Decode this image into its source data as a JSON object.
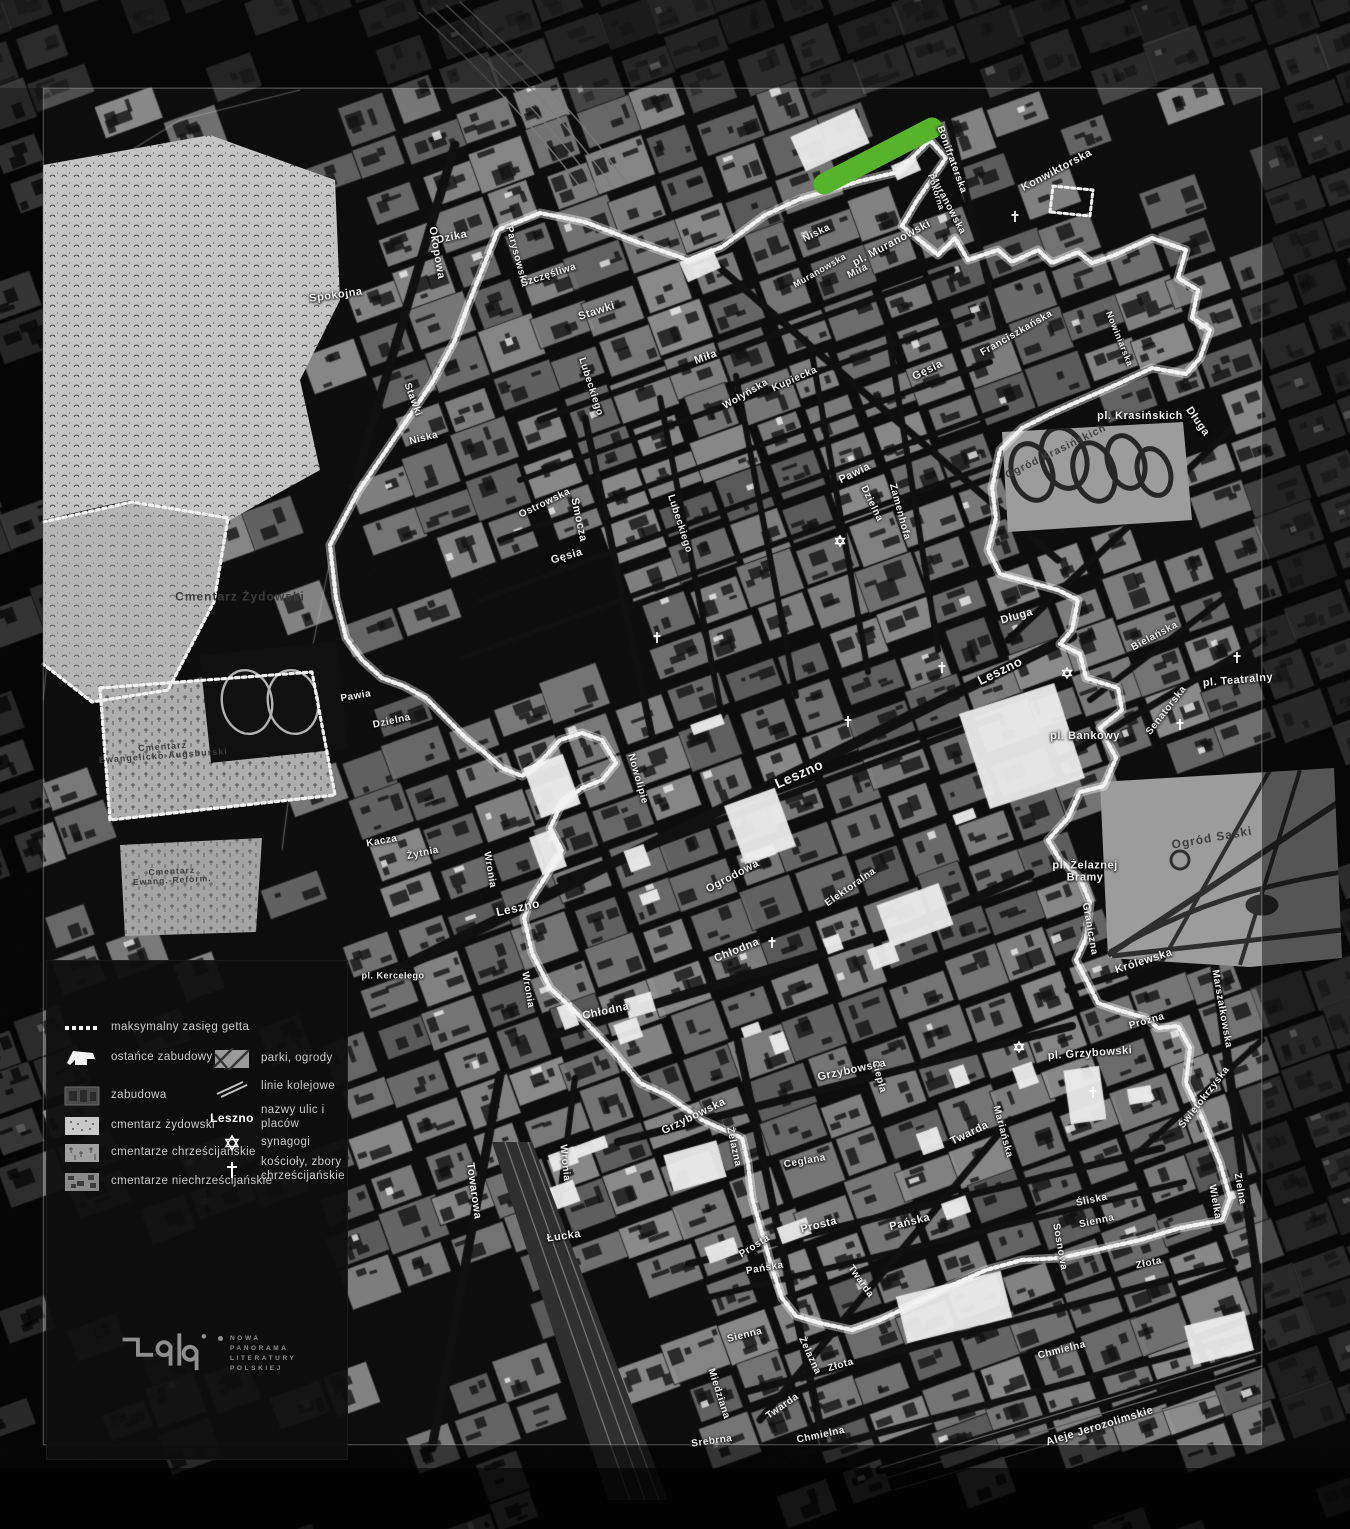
{
  "colors": {
    "background": "#0b0b0b",
    "block_gray": "#8a8a8a",
    "boundary_white": "#f2f2f2",
    "highlight_green": "#57b32c",
    "cemetery_light": "#c4c4c4",
    "park_gray": "#9c9c9c",
    "label_white": "#efefef"
  },
  "legend": {
    "items_left": [
      {
        "swatch": "ghetto-boundary",
        "label": "maksymalny zasięg getta"
      },
      {
        "swatch": "surviving-buildings",
        "label": "ostańce zabudowy"
      },
      {
        "swatch": "buildings",
        "label": "zabudowa"
      },
      {
        "swatch": "jewish-cemetery",
        "label": "cmentarz żydowski"
      },
      {
        "swatch": "christian-cemeteries",
        "label": "cmentarze chrześcijańskie"
      },
      {
        "swatch": "non-christian-cemeteries",
        "label": "cmentarze niechrześcijańskie"
      }
    ],
    "items_right": [
      {
        "swatch": "parks",
        "label": "parki, ogrody"
      },
      {
        "swatch": "railways",
        "label": "linie kolejowe"
      },
      {
        "swatch": "street-name-sample",
        "label": "nazwy ulic i placów",
        "sample": "Leszno"
      },
      {
        "swatch": "synagogue-star",
        "label": "synagogi"
      },
      {
        "swatch": "church-cross",
        "label": "kościoły, zbory\nchrześcijańskie"
      }
    ]
  },
  "logo": {
    "lines": [
      "NOWA",
      "PANORAMA",
      "LITERATURY",
      "POLSKIEJ"
    ]
  },
  "map": {
    "labels": [
      [
        "Dzika",
        452,
        238,
        -12,
        11,
        "street"
      ],
      [
        "Okopowa",
        436,
        253,
        80,
        11,
        "street"
      ],
      [
        "Spokojna",
        336,
        296,
        -8,
        11,
        "street"
      ],
      [
        "Parysowska",
        516,
        257,
        75,
        10,
        "street"
      ],
      [
        "Szczęśliwa",
        549,
        276,
        -18,
        10,
        "street"
      ],
      [
        "Stawki",
        597,
        312,
        -18,
        11,
        "street"
      ],
      [
        "Stawki",
        412,
        400,
        70,
        10,
        "street"
      ],
      [
        "Smocza",
        578,
        520,
        78,
        11,
        "street"
      ],
      [
        "Niska",
        424,
        439,
        -14,
        10,
        "street"
      ],
      [
        "Niska",
        817,
        234,
        -26,
        10,
        "street"
      ],
      [
        "Miła",
        706,
        358,
        -20,
        11,
        "street"
      ],
      [
        "Miła",
        858,
        272,
        -26,
        10,
        "street"
      ],
      [
        "Kupiecka",
        795,
        380,
        -24,
        10,
        "street"
      ],
      [
        "Wołyńska",
        746,
        395,
        -30,
        10,
        "street"
      ],
      [
        "Lubeckiego",
        590,
        387,
        72,
        10,
        "street"
      ],
      [
        "Lubeckiego",
        679,
        524,
        72,
        10,
        "street"
      ],
      [
        "Ostrowska",
        545,
        504,
        -26,
        10,
        "street"
      ],
      [
        "Gęsia",
        567,
        557,
        -16,
        11,
        "street"
      ],
      [
        "Gęsia",
        928,
        371,
        -26,
        11,
        "street"
      ],
      [
        "Pawia",
        855,
        474,
        -26,
        11,
        "street"
      ],
      [
        "Pawia",
        356,
        697,
        -10,
        10,
        "street"
      ],
      [
        "Dzielna",
        871,
        504,
        64,
        10,
        "street"
      ],
      [
        "Dzielna",
        392,
        722,
        -12,
        10,
        "street"
      ],
      [
        "Zamenhofa",
        899,
        512,
        75,
        10,
        "street"
      ],
      [
        "Kacza",
        382,
        842,
        -10,
        10,
        "street"
      ],
      [
        "Żytnia",
        423,
        854,
        -12,
        10,
        "street"
      ],
      [
        "Wronia",
        489,
        870,
        80,
        10,
        "street"
      ],
      [
        "Wronia",
        527,
        990,
        80,
        10,
        "street"
      ],
      [
        "Wronia",
        564,
        1163,
        84,
        10,
        "street"
      ],
      [
        "Leszno",
        1000,
        671,
        -26,
        13,
        "street"
      ],
      [
        "Leszno",
        799,
        774,
        -24,
        14,
        "street"
      ],
      [
        "Leszno",
        518,
        908,
        -12,
        12,
        "street"
      ],
      [
        "Nowolipie",
        637,
        779,
        74,
        10,
        "street"
      ],
      [
        "Ogrodowa",
        733,
        877,
        -28,
        11,
        "street"
      ],
      [
        "Chłodna",
        737,
        951,
        -22,
        11,
        "street"
      ],
      [
        "Chłodna",
        606,
        1012,
        -12,
        11,
        "street"
      ],
      [
        "Elektoralna",
        851,
        888,
        -35,
        10,
        "street"
      ],
      [
        "Towarowa",
        473,
        1191,
        82,
        11,
        "street"
      ],
      [
        "Łucka",
        564,
        1237,
        -8,
        11,
        "street"
      ],
      [
        "Miedziana",
        718,
        1394,
        72,
        10,
        "street"
      ],
      [
        "Srebrna",
        712,
        1442,
        -8,
        10,
        "street"
      ],
      [
        "Twarda",
        970,
        1134,
        -26,
        11,
        "street"
      ],
      [
        "Twarda",
        783,
        1407,
        -35,
        10,
        "street"
      ],
      [
        "Twarda",
        860,
        1282,
        55,
        10,
        "street"
      ],
      [
        "Mariańska",
        1002,
        1132,
        75,
        10,
        "street"
      ],
      [
        "Grzybowska",
        852,
        1071,
        -12,
        11,
        "street"
      ],
      [
        "Grzybowska",
        694,
        1117,
        -26,
        11,
        "street"
      ],
      [
        "Ciepła",
        878,
        1077,
        75,
        10,
        "street"
      ],
      [
        "Żelazna",
        733,
        1147,
        78,
        10,
        "street"
      ],
      [
        "Żelazna",
        809,
        1356,
        65,
        10,
        "street"
      ],
      [
        "Ceglana",
        805,
        1162,
        -10,
        10,
        "street"
      ],
      [
        "Prosta",
        819,
        1226,
        -14,
        11,
        "street"
      ],
      [
        "Prosta",
        755,
        1247,
        -32,
        10,
        "street"
      ],
      [
        "Pańska",
        910,
        1223,
        -14,
        11,
        "street"
      ],
      [
        "Pańska",
        765,
        1269,
        -10,
        10,
        "street"
      ],
      [
        "Sienna",
        745,
        1336,
        -14,
        10,
        "street"
      ],
      [
        "Sienna",
        1097,
        1222,
        -12,
        10,
        "street"
      ],
      [
        "Śliska",
        1092,
        1201,
        -12,
        10,
        "street"
      ],
      [
        "Złota",
        1149,
        1264,
        -12,
        10,
        "street"
      ],
      [
        "Złota",
        841,
        1366,
        -16,
        10,
        "street"
      ],
      [
        "Chmielna",
        1062,
        1351,
        -14,
        10,
        "street"
      ],
      [
        "Chmielna",
        821,
        1436,
        -12,
        10,
        "street"
      ],
      [
        "Sosnowa",
        1059,
        1247,
        80,
        10,
        "street"
      ],
      [
        "Wielka",
        1214,
        1202,
        80,
        10,
        "street"
      ],
      [
        "Marszałkowska",
        1221,
        1009,
        80,
        10,
        "street"
      ],
      [
        "Zielna",
        1239,
        1189,
        80,
        10,
        "street"
      ],
      [
        "Świętokrzyska",
        1205,
        1098,
        -52,
        10,
        "street"
      ],
      [
        "Próżna",
        1147,
        1022,
        -16,
        10,
        "street"
      ],
      [
        "Królewska",
        1144,
        962,
        -18,
        11,
        "street"
      ],
      [
        "Graniczna",
        1089,
        929,
        80,
        10,
        "street"
      ],
      [
        "Muranowska",
        947,
        205,
        62,
        10,
        "street"
      ],
      [
        "Muranowska",
        820,
        271,
        -30,
        9,
        "street"
      ],
      [
        "Konwiktorska",
        1057,
        171,
        -28,
        11,
        "street"
      ],
      [
        "Bonifraterska",
        951,
        160,
        70,
        10,
        "street"
      ],
      [
        "Pokorna",
        936,
        192,
        72,
        8.5,
        "street"
      ],
      [
        "Franciszkańska",
        1017,
        334,
        -30,
        10,
        "street"
      ],
      [
        "Nowiniarska",
        1119,
        339,
        68,
        9,
        "street"
      ],
      [
        "Długa",
        1197,
        422,
        55,
        11,
        "street"
      ],
      [
        "Długa",
        1017,
        617,
        -16,
        11,
        "street"
      ],
      [
        "Bielańska",
        1155,
        637,
        -28,
        10,
        "street"
      ],
      [
        "Senatorska",
        1167,
        711,
        -52,
        10,
        "street"
      ],
      [
        "Aleje Jerozolimskie",
        1100,
        1427,
        -17,
        11,
        "street"
      ],
      [
        "pl. Muranowski",
        892,
        244,
        -28,
        11,
        "place"
      ],
      [
        "pl. Krasińskich",
        1140,
        417,
        0,
        11,
        "place"
      ],
      [
        "pl. Teatralny",
        1238,
        681,
        -5,
        11,
        "place"
      ],
      [
        "pl. Bankowy",
        1085,
        737,
        0,
        11,
        "place"
      ],
      [
        "pl. Żelaznej\nBramy",
        1085,
        872,
        0,
        11,
        "place"
      ],
      [
        "pl. Grzybowski",
        1090,
        1054,
        -4,
        11,
        "place"
      ],
      [
        "pl. Kercelego",
        393,
        976,
        0,
        9,
        "place"
      ],
      [
        "Cmentarz Żydowski",
        240,
        597,
        0,
        12,
        "area"
      ],
      [
        "Cmentarz\nEwangelicko-Augsburski",
        163,
        752,
        -4,
        9,
        "area"
      ],
      [
        "Cmentarz\nEwang.-Reform.",
        172,
        876,
        -3,
        8.5,
        "area"
      ],
      [
        "Ogród Krasińskich",
        1056,
        452,
        -26,
        10.5,
        "area"
      ],
      [
        "Ogród Saski",
        1212,
        838,
        -10,
        12,
        "area"
      ]
    ],
    "symbols": {
      "synagogues": [
        [
          840,
          541
        ],
        [
          1067,
          673
        ],
        [
          1019,
          1047
        ]
      ],
      "churches": [
        [
          657,
          638
        ],
        [
          848,
          722
        ],
        [
          942,
          668
        ],
        [
          1093,
          1093
        ],
        [
          1237,
          658
        ],
        [
          1180,
          725
        ],
        [
          772,
          943
        ],
        [
          1015,
          217
        ]
      ]
    }
  }
}
